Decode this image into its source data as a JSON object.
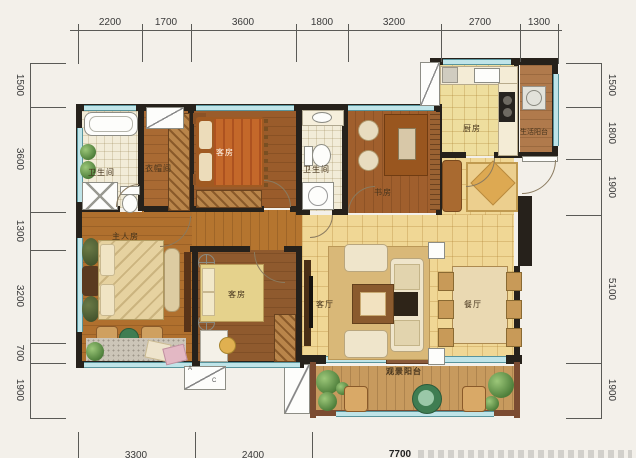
{
  "dimensions": {
    "top": [
      "2200",
      "1700",
      "3600",
      "1800",
      "3200",
      "2700",
      "1300"
    ],
    "left": [
      "1500",
      "3600",
      "1300",
      "3200",
      "700",
      "1900"
    ],
    "right": [
      "1500",
      "1800",
      "1900",
      "5100",
      "1900"
    ],
    "bottom_clipped": [
      "3300",
      "2400",
      "7700"
    ]
  },
  "rooms": {
    "bathroom_top": "卫生间",
    "cloakroom": "衣帽间",
    "guest_room_top": "客房",
    "bathroom_mid": "卫生间",
    "study": "书房",
    "kitchen": "厨房",
    "service_balcony": "生活阳台",
    "master_bedroom": "主人房",
    "guest_room_bottom": "客房",
    "living_room": "客厅",
    "dining_room": "餐厅",
    "view_balcony": "观景阳台"
  },
  "annotations": {
    "ac_a": "A",
    "ac_c": "C"
  },
  "colors": {
    "wall": "#26211b",
    "window": "#bfe4e8",
    "wood_floor": "#ad6c2f",
    "tile_floor": "#f0d795",
    "bath_tile": "#f2ecd8",
    "balcony_floor": "#c79a5e"
  }
}
